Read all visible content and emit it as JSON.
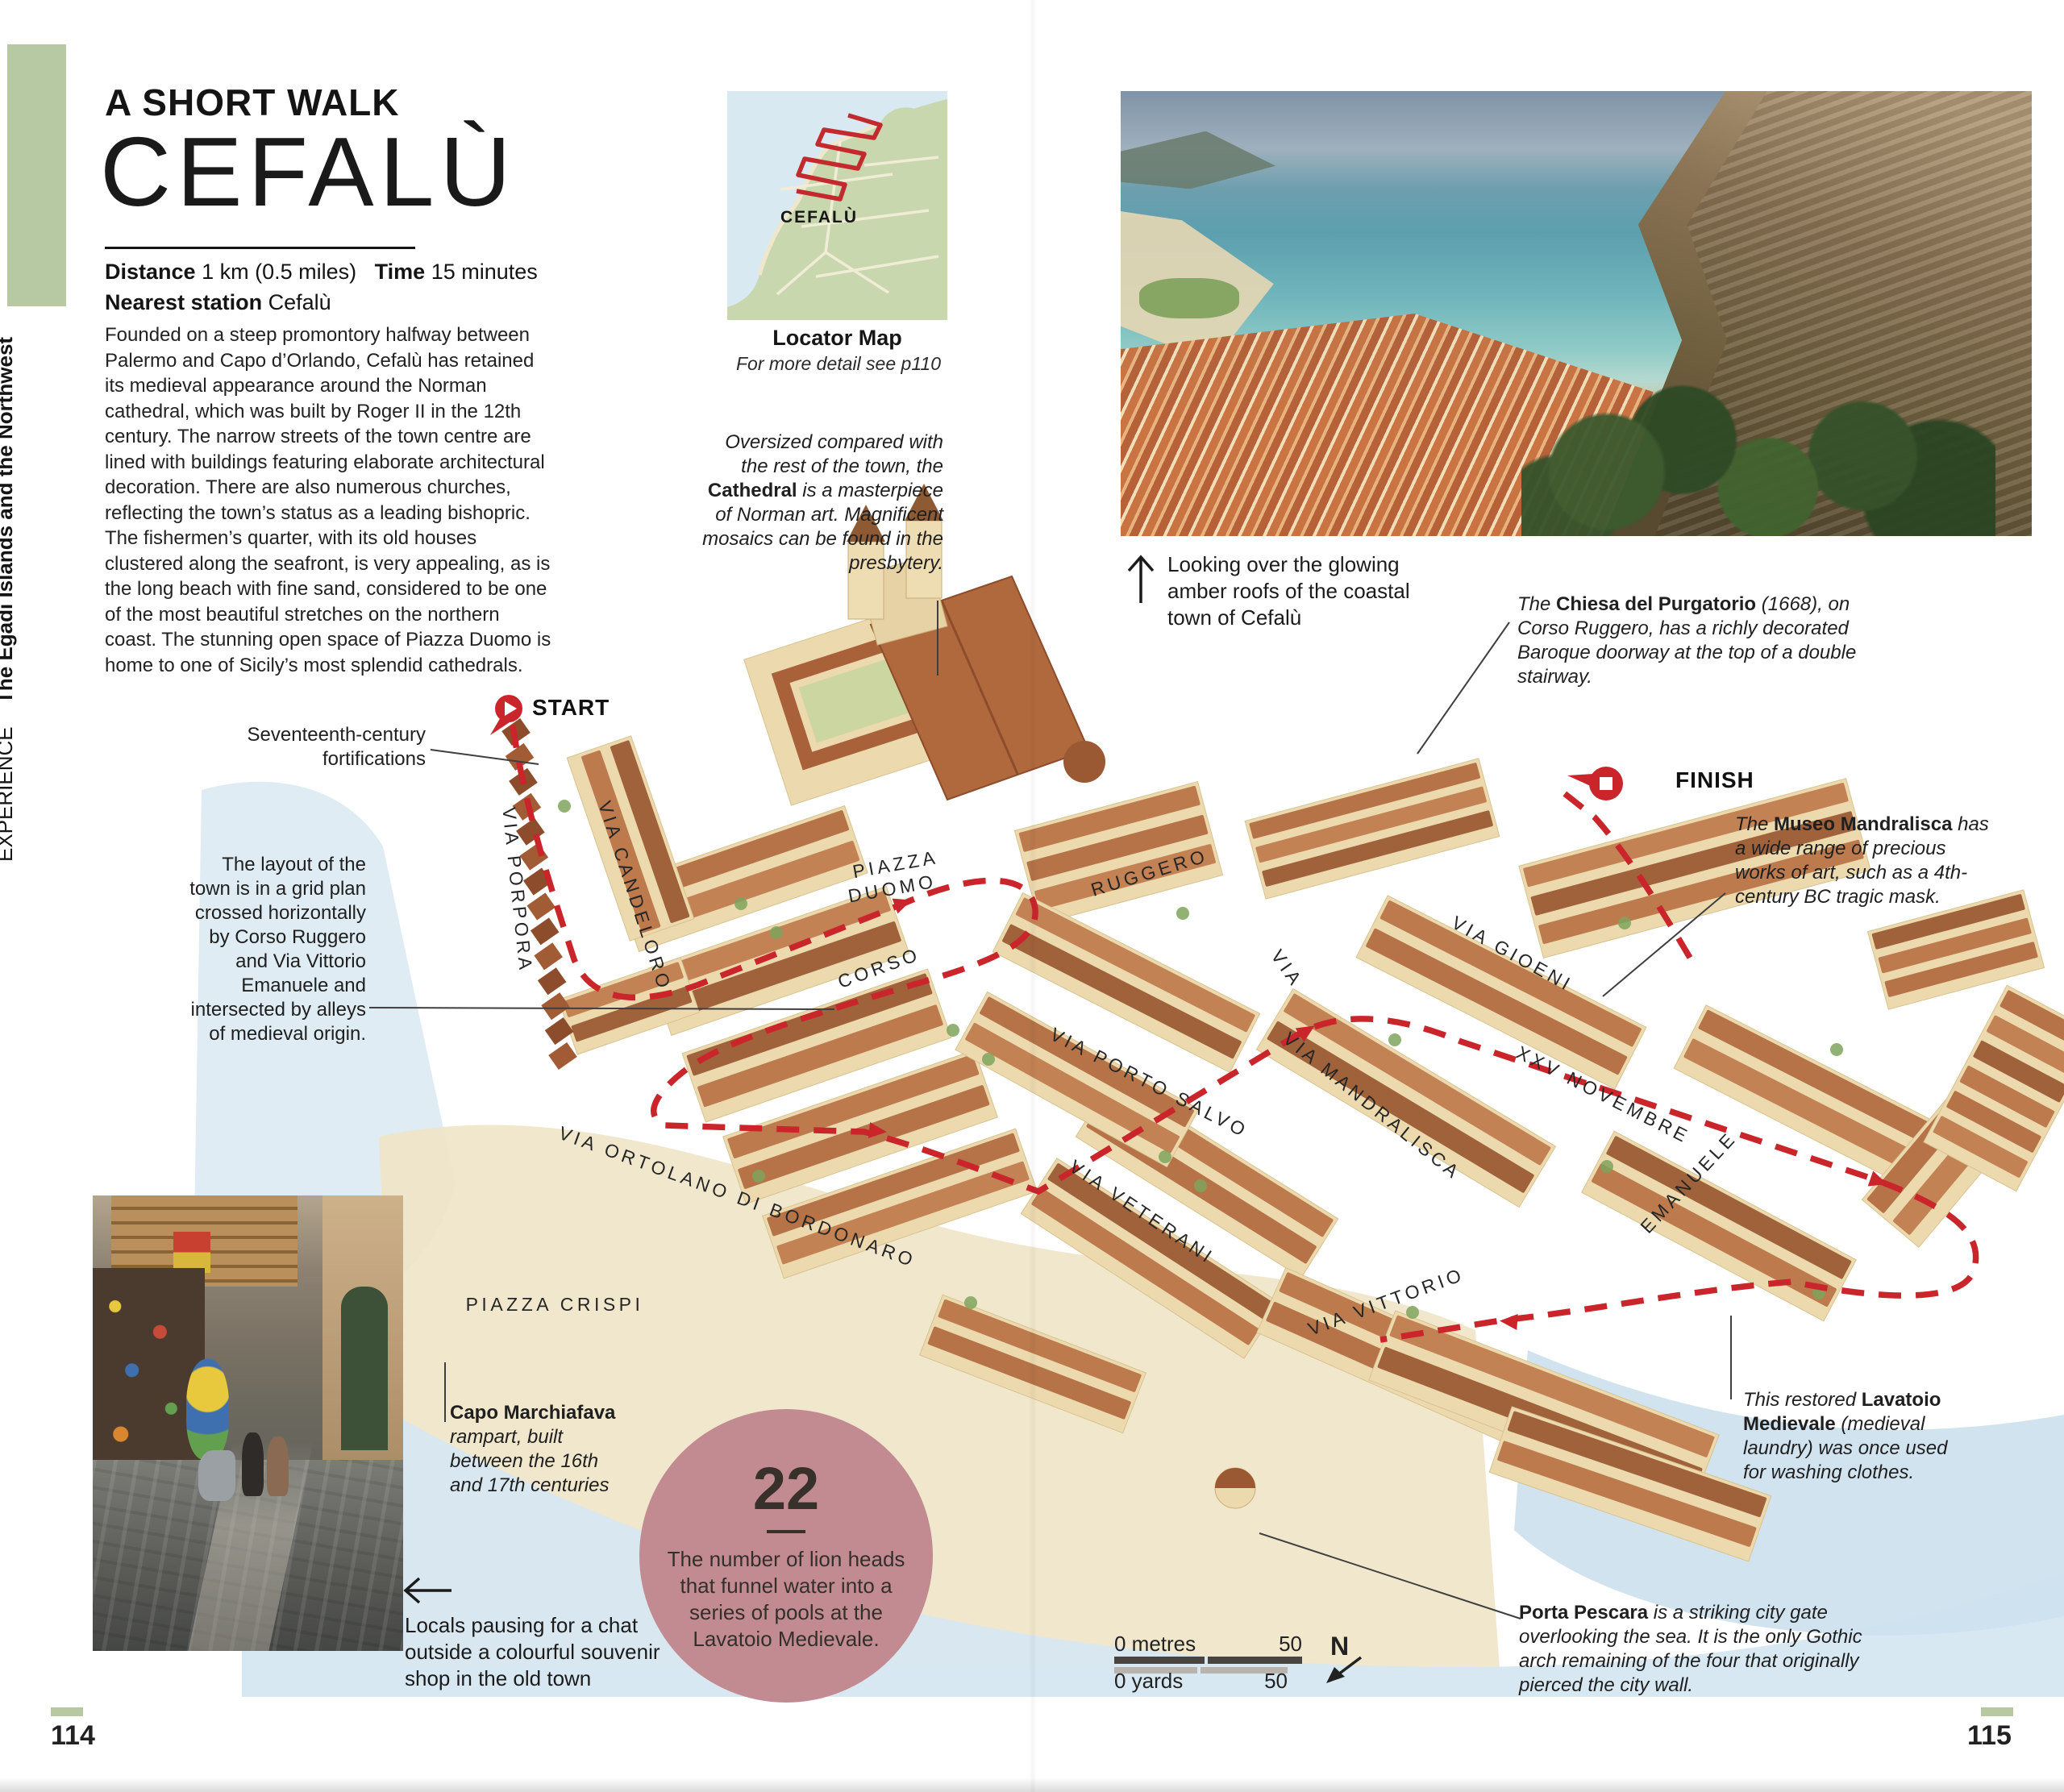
{
  "sidebar": {
    "section": "EXPERIENCE",
    "region": "The Egadi Islands and the Northwest"
  },
  "header": {
    "kicker": "A SHORT WALK",
    "title": "CEFALÙ",
    "distance_label": "Distance",
    "distance_value": "1 km (0.5 miles)",
    "time_label": "Time",
    "time_value": "15 minutes",
    "station_label": "Nearest station",
    "station_value": "Cefalù"
  },
  "intro": "Founded on a steep promontory halfway between Palermo and Capo d’Orlando, Cefalù has retained its medieval appearance around the Norman cathedral, which was built by Roger II in the 12th century. The narrow streets of the town centre are lined with buildings featuring elaborate architectural decoration. There are also numerous churches, reflecting the town’s status as a leading bishopric. The fishermen’s quarter, with its old houses clustered along the seafront, is very appealing, as is the long beach with fine sand, considered to be one of the most beautiful stretches on the northern coast. The stunning open space of Piazza Duomo is home to one of Sicily’s most splendid cathedrals.",
  "locator": {
    "label": "CEFALÙ",
    "title": "Locator Map",
    "note": "For more detail see p110"
  },
  "captions": {
    "photo": "Looking over the glowing amber roofs of the coastal town of Cefalù",
    "shop": "Locals pausing for a chat outside a colourful souvenir shop in the old town"
  },
  "annotations": {
    "cathedral": {
      "pre": "Oversized compared with the rest of the town, the ",
      "bold": "Cathedral",
      "post": " is a masterpiece of Norman art. Magnificent mosaics can be found in the presbytery."
    },
    "fortifications": {
      "text": "Seventeenth-century fortifications"
    },
    "layout": {
      "text": "The layout of the town is in a grid plan crossed horizontally by Corso Ruggero and Via Vittorio Emanuele and intersected by alleys of medieval origin."
    },
    "purgatorio": {
      "pre": "The ",
      "bold": "Chiesa del Purgatorio",
      "post": " (1668), on Corso Ruggero, has a richly decorated Baroque doorway at the top of a double stairway."
    },
    "mandralisca": {
      "pre": "The ",
      "bold": "Museo Mandralisca",
      "post": " has a wide range of precious works of art, such as a 4th-century BC tragic mask."
    },
    "marchiafava": {
      "bold": "Capo Marchiafava",
      "post": "rampart, built between the 16th and 17th centuries"
    },
    "lavatoio": {
      "pre": "This restored ",
      "bold": "Lavatoio Medievale",
      "post": " (medieval laundry) was once used for washing clothes."
    },
    "pescara": {
      "bold": "Porta Pescara",
      "post": " is a striking city gate overlooking the sea. It is the only Gothic arch remaining of the four that originally pierced the city wall."
    }
  },
  "map": {
    "start_label": "START",
    "finish_label": "FINISH",
    "piazza_duomo": {
      "line1": "PIAZZA",
      "line2": "DUOMO"
    },
    "streets": [
      {
        "name": "VIA PORPORA"
      },
      {
        "name": "VIA CANDELORO"
      },
      {
        "name": "CORSO"
      },
      {
        "name": "RUGGERO"
      },
      {
        "name": "VIA"
      },
      {
        "name": "VIA GIOENI"
      },
      {
        "name": "XXV NOVEMBRE"
      },
      {
        "name": "VIA MANDRALISCA"
      },
      {
        "name": "VIA PORTO SALVO"
      },
      {
        "name": "VIA VETERANI"
      },
      {
        "name": "EMANUELE"
      },
      {
        "name": "VIA VITTORIO"
      },
      {
        "name": "VIA ORTOLANO DI BORDONARO"
      },
      {
        "name": "PIAZZA CRISPI"
      }
    ]
  },
  "fact_circle": {
    "number": "22",
    "text": "The number of lion heads that funnel water into a series of pools at the Lavatoio Medievale."
  },
  "scale": {
    "metres_label": "0 metres",
    "metres_value": "50",
    "yards_label": "0 yards",
    "yards_value": "50",
    "north": "N"
  },
  "pages": {
    "left": "114",
    "right": "115"
  },
  "colors": {
    "route_red": "#c9252b",
    "sidebar_green": "#b6c9a3",
    "circle_pink": "#c28b91",
    "roof_terracotta": "#b06a3f",
    "wall_cream": "#ecd9ae",
    "water_blue": "#d9e9f2",
    "land_green": "#c8d7ae"
  }
}
